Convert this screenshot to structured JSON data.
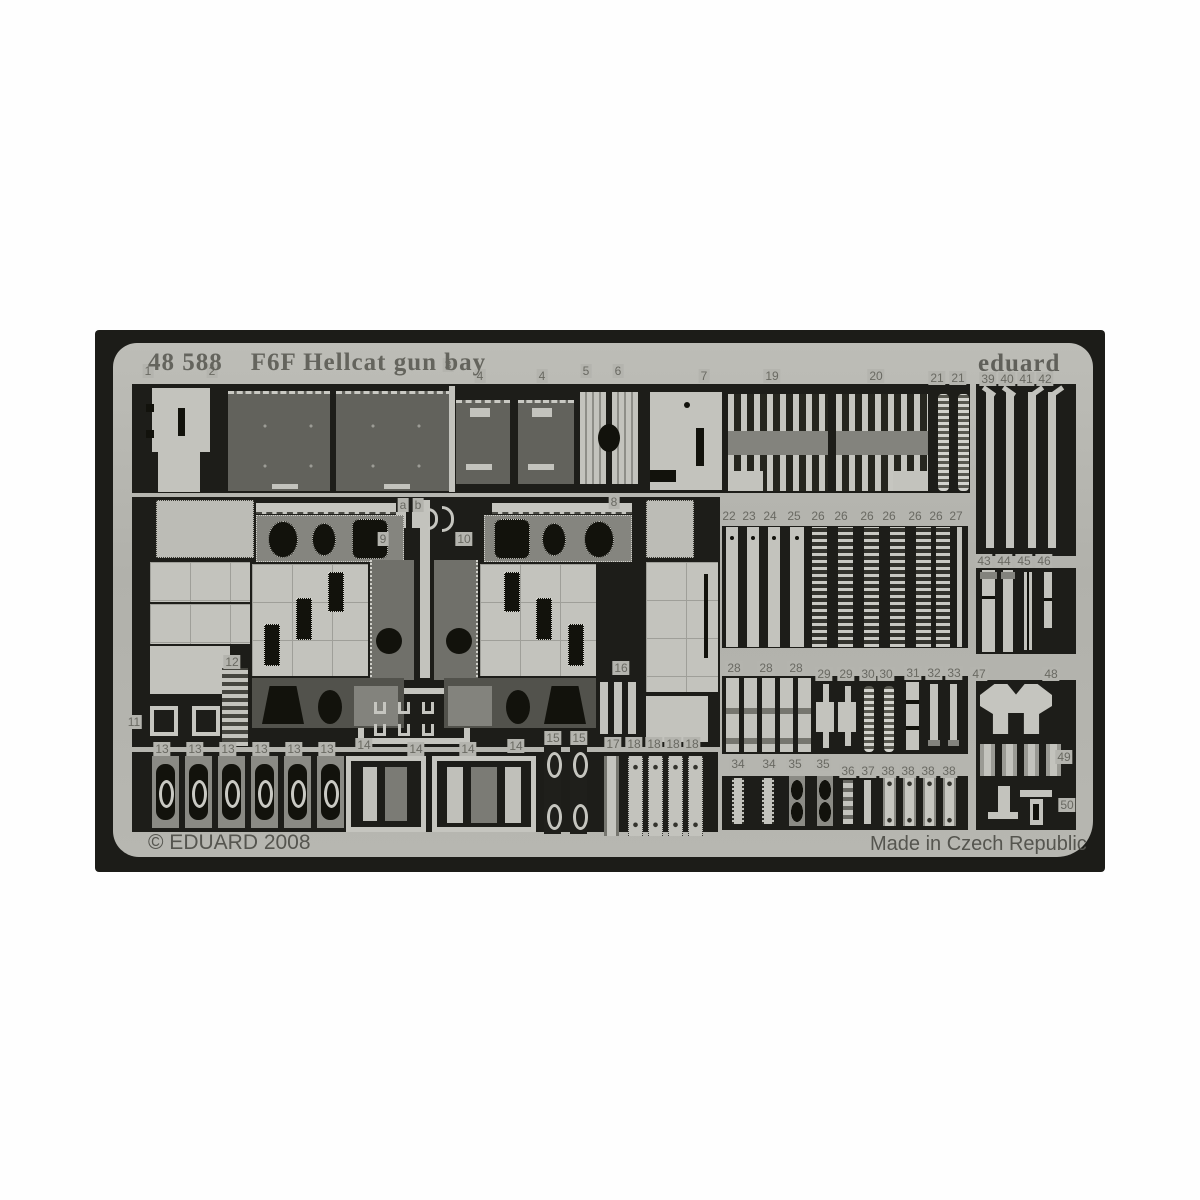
{
  "header": {
    "catalog_number": "48 588",
    "title": "F6F Hellcat gun bay",
    "brand": "eduard"
  },
  "footer": {
    "copyright": "© EDUARD 2008",
    "made_in": "Made in Czech Republic"
  },
  "sheet": {
    "colors": {
      "photo_background": "#1c1c18",
      "fret_metal": "#b5b5af",
      "dark_panel": "#62625c",
      "mid_panel": "#83837d",
      "light_part": "#c3c3bd",
      "cutout_black": "#12120c",
      "label_text": "#696962"
    },
    "part_labels": [
      {
        "t": "1",
        "x": 148,
        "y": 372
      },
      {
        "t": "2",
        "x": 212,
        "y": 372
      },
      {
        "t": "3",
        "x": 448,
        "y": 366
      },
      {
        "t": "4",
        "x": 480,
        "y": 377
      },
      {
        "t": "4",
        "x": 542,
        "y": 377
      },
      {
        "t": "5",
        "x": 586,
        "y": 372
      },
      {
        "t": "6",
        "x": 618,
        "y": 372
      },
      {
        "t": "7",
        "x": 704,
        "y": 377
      },
      {
        "t": "19",
        "x": 772,
        "y": 377
      },
      {
        "t": "20",
        "x": 876,
        "y": 377
      },
      {
        "t": "21",
        "x": 937,
        "y": 379
      },
      {
        "t": "21",
        "x": 958,
        "y": 379
      },
      {
        "t": "39",
        "x": 988,
        "y": 380
      },
      {
        "t": "40",
        "x": 1007,
        "y": 380
      },
      {
        "t": "41",
        "x": 1026,
        "y": 380
      },
      {
        "t": "42",
        "x": 1045,
        "y": 380
      },
      {
        "t": "a",
        "x": 403,
        "y": 506
      },
      {
        "t": "b",
        "x": 418,
        "y": 506
      },
      {
        "t": "9",
        "x": 383,
        "y": 540
      },
      {
        "t": "10",
        "x": 464,
        "y": 540
      },
      {
        "t": "8",
        "x": 614,
        "y": 503
      },
      {
        "t": "22",
        "x": 729,
        "y": 517
      },
      {
        "t": "23",
        "x": 749,
        "y": 517
      },
      {
        "t": "24",
        "x": 770,
        "y": 517
      },
      {
        "t": "25",
        "x": 794,
        "y": 517
      },
      {
        "t": "26",
        "x": 818,
        "y": 517
      },
      {
        "t": "26",
        "x": 841,
        "y": 517
      },
      {
        "t": "26",
        "x": 867,
        "y": 517
      },
      {
        "t": "26",
        "x": 889,
        "y": 517
      },
      {
        "t": "26",
        "x": 915,
        "y": 517
      },
      {
        "t": "26",
        "x": 936,
        "y": 517
      },
      {
        "t": "27",
        "x": 956,
        "y": 517
      },
      {
        "t": "43",
        "x": 984,
        "y": 562
      },
      {
        "t": "44",
        "x": 1004,
        "y": 562
      },
      {
        "t": "45",
        "x": 1024,
        "y": 562
      },
      {
        "t": "46",
        "x": 1044,
        "y": 562
      },
      {
        "t": "11",
        "x": 134,
        "y": 723
      },
      {
        "t": "12",
        "x": 232,
        "y": 663
      },
      {
        "t": "13",
        "x": 162,
        "y": 750
      },
      {
        "t": "13",
        "x": 195,
        "y": 750
      },
      {
        "t": "13",
        "x": 228,
        "y": 750
      },
      {
        "t": "13",
        "x": 261,
        "y": 750
      },
      {
        "t": "13",
        "x": 294,
        "y": 750
      },
      {
        "t": "13",
        "x": 327,
        "y": 750
      },
      {
        "t": "14",
        "x": 364,
        "y": 746
      },
      {
        "t": "14",
        "x": 416,
        "y": 750
      },
      {
        "t": "14",
        "x": 468,
        "y": 750
      },
      {
        "t": "14",
        "x": 516,
        "y": 747
      },
      {
        "t": "15",
        "x": 553,
        "y": 739
      },
      {
        "t": "15",
        "x": 579,
        "y": 739
      },
      {
        "t": "16",
        "x": 621,
        "y": 669
      },
      {
        "t": "17",
        "x": 613,
        "y": 745
      },
      {
        "t": "18",
        "x": 634,
        "y": 745
      },
      {
        "t": "18",
        "x": 654,
        "y": 745
      },
      {
        "t": "18",
        "x": 673,
        "y": 745
      },
      {
        "t": "18",
        "x": 692,
        "y": 745
      },
      {
        "t": "28",
        "x": 734,
        "y": 669
      },
      {
        "t": "28",
        "x": 766,
        "y": 669
      },
      {
        "t": "28",
        "x": 796,
        "y": 669
      },
      {
        "t": "29",
        "x": 824,
        "y": 675
      },
      {
        "t": "29",
        "x": 846,
        "y": 675
      },
      {
        "t": "30",
        "x": 868,
        "y": 675
      },
      {
        "t": "30",
        "x": 886,
        "y": 675
      },
      {
        "t": "31",
        "x": 913,
        "y": 674
      },
      {
        "t": "32",
        "x": 934,
        "y": 674
      },
      {
        "t": "33",
        "x": 954,
        "y": 674
      },
      {
        "t": "34",
        "x": 738,
        "y": 765
      },
      {
        "t": "34",
        "x": 769,
        "y": 765
      },
      {
        "t": "35",
        "x": 795,
        "y": 765
      },
      {
        "t": "35",
        "x": 823,
        "y": 765
      },
      {
        "t": "36",
        "x": 848,
        "y": 772
      },
      {
        "t": "37",
        "x": 868,
        "y": 772
      },
      {
        "t": "38",
        "x": 888,
        "y": 772
      },
      {
        "t": "38",
        "x": 908,
        "y": 772
      },
      {
        "t": "38",
        "x": 928,
        "y": 772
      },
      {
        "t": "38",
        "x": 949,
        "y": 772
      },
      {
        "t": "47",
        "x": 979,
        "y": 675
      },
      {
        "t": "48",
        "x": 1051,
        "y": 675
      },
      {
        "t": "49",
        "x": 1064,
        "y": 758
      },
      {
        "t": "50",
        "x": 1067,
        "y": 806
      }
    ]
  }
}
